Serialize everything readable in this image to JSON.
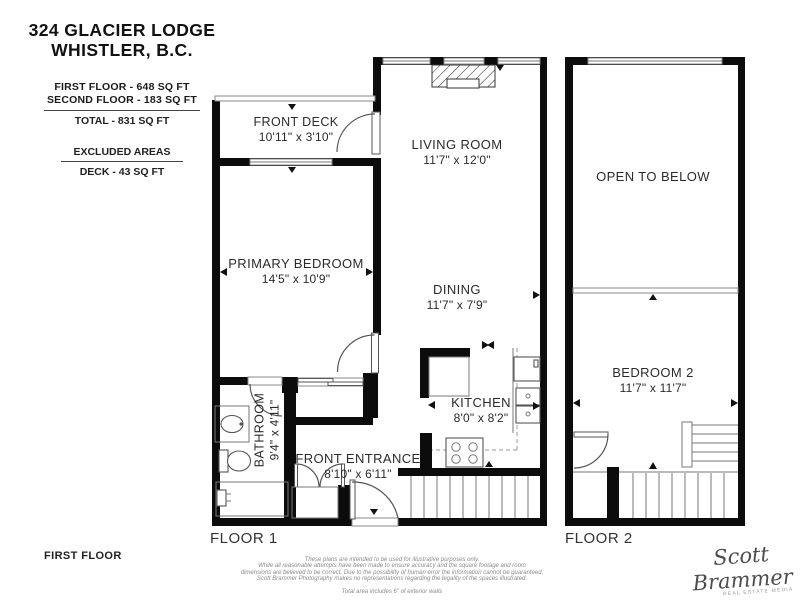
{
  "info": {
    "title_line1": "324 GLACIER LODGE",
    "title_line2": "WHISTLER, B.C.",
    "first_floor_area": "FIRST FLOOR - 648 SQ FT",
    "second_floor_area": "SECOND FLOOR - 183 SQ FT",
    "total_area": "TOTAL  -  831 SQ FT",
    "excluded_heading": "EXCLUDED AREAS",
    "excluded_deck": "DECK - 43 SQ FT"
  },
  "rooms": {
    "front_deck": {
      "name": "FRONT DECK",
      "dims": "10'11\" x 3'10\""
    },
    "living_room": {
      "name": "LIVING ROOM",
      "dims": "11'7\" x 12'0\""
    },
    "primary_bedroom": {
      "name": "PRIMARY BEDROOM",
      "dims": "14'5\" x 10'9\""
    },
    "dining": {
      "name": "DINING",
      "dims": "11'7\" x 7'9\""
    },
    "kitchen": {
      "name": "KITCHEN",
      "dims": "8'0\" x 8'2\""
    },
    "bathroom": {
      "name": "BATHROOM",
      "dims": "9'4\" x 4'11\""
    },
    "front_entrance": {
      "name": "FRONT ENTRANCE",
      "dims": "8'10\" x 6'11\""
    },
    "open_to_below": {
      "name": "OPEN TO BELOW"
    },
    "bedroom_2": {
      "name": "BEDROOM 2",
      "dims": "11'7\" x 11'7\""
    }
  },
  "labels": {
    "floor1": "FLOOR 1",
    "floor2": "FLOOR 2",
    "page_floor": "FIRST FLOOR"
  },
  "disclaimer": {
    "line1": "These plans are intended to be used for illustrative purposes only.",
    "line2": "While all reasonable attempts have been made to ensure accuracy and the square footage and room",
    "line3": "dimensions are believed to be correct. Due to the possibility of human error the information cannot be guaranteed.",
    "line4": "Scott Brammer Photography makes no representations regarding the legality of the spaces illustrated.",
    "total_note": "Total area includes 6\" of exterior walls"
  },
  "signature": {
    "name": "Scott Brammer",
    "tagline": "REAL ESTATE MEDIA"
  },
  "colors": {
    "wall": "#0c0c0c",
    "text": "#2b2b2b",
    "background": "#ffffff"
  }
}
